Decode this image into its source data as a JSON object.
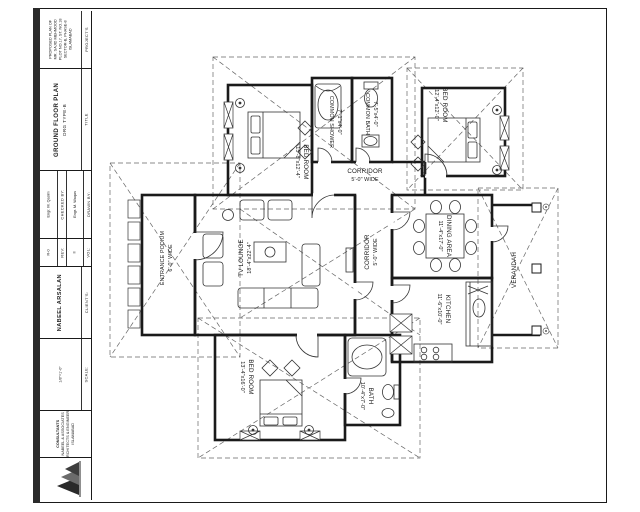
{
  "sheet": {
    "kind": "architectural floor plan drawing",
    "ink_color": "#1a1a1a",
    "dash_color": "#666666"
  },
  "title_block": {
    "project": {
      "header": "PROJECT'S",
      "lines": [
        "PROPOSED PLAN OF",
        "MR. SAJID MEHMOOD",
        "PLOT NO.17, ST. NO.18",
        "SECTOR-B, PHASE-8",
        "ISLAMABAD"
      ]
    },
    "title": {
      "header": "TITLE",
      "lines": [
        "GROUND FLOOR PLAN",
        "DRG TYPE-B"
      ]
    },
    "checked": {
      "header": "CHECKED BY:",
      "name": "Engr. M. Qasim"
    },
    "drawn": {
      "header": "DRAWN BY:",
      "name": "Engr. M. Waqas"
    },
    "rev": {
      "header": "REV:",
      "value": "R-0"
    },
    "vol": {
      "header": "VOL:",
      "value": "II"
    },
    "client": {
      "header": "CLIENT'S:",
      "name": "NABEEL ARSALAN"
    },
    "scale": {
      "header": "SCALE:",
      "value": "1/8\"=1'-0\""
    },
    "consultant": {
      "header": "CONSULTANTS:",
      "lines": [
        "CONSULTANTS",
        "NABEEL & ASSOCIATES",
        "ARCHITECTS & ENGINEERS",
        "ISLAMABAD"
      ]
    }
  },
  "rooms": {
    "bed_tl": {
      "name": "BED ROOM",
      "dims": "15'-8\"x12'-4\""
    },
    "shower": {
      "name": "COMMON SHOWER",
      "dims": "7'-1\"x4'-0\""
    },
    "bath_c": {
      "name": "COMMON BATH",
      "dims": "7'-5\"x4'-0\""
    },
    "bed_tr": {
      "name": "BED ROOM",
      "dims": "12'-4\"x12'-0\""
    },
    "corr_top": {
      "name": "CORRIDOR",
      "dims": "5'-0\" WIDE"
    },
    "dining": {
      "name": "DINING AREA",
      "dims": "11'-4\"x17'-0\""
    },
    "corr_mid": {
      "name": "CORRIDOR",
      "dims": "5'-0\" WIDE"
    },
    "lounge": {
      "name": "TV LOUNGE",
      "dims": "18'-4\"x22'-4\""
    },
    "entrance": {
      "name": "ENTRANCE PODIUM",
      "dims": "6'-0\" WIDE"
    },
    "kitchen": {
      "name": "KITCHEN",
      "dims": "11'-6\"x10'-0\""
    },
    "verandah": {
      "name": "VERANDAH",
      "dims": ""
    },
    "bed_b": {
      "name": "BED ROOM",
      "dims": "13'-4\"x16'-0\""
    },
    "bath_b": {
      "name": "BATH",
      "dims": "10'-4\"x7'-0\""
    }
  }
}
